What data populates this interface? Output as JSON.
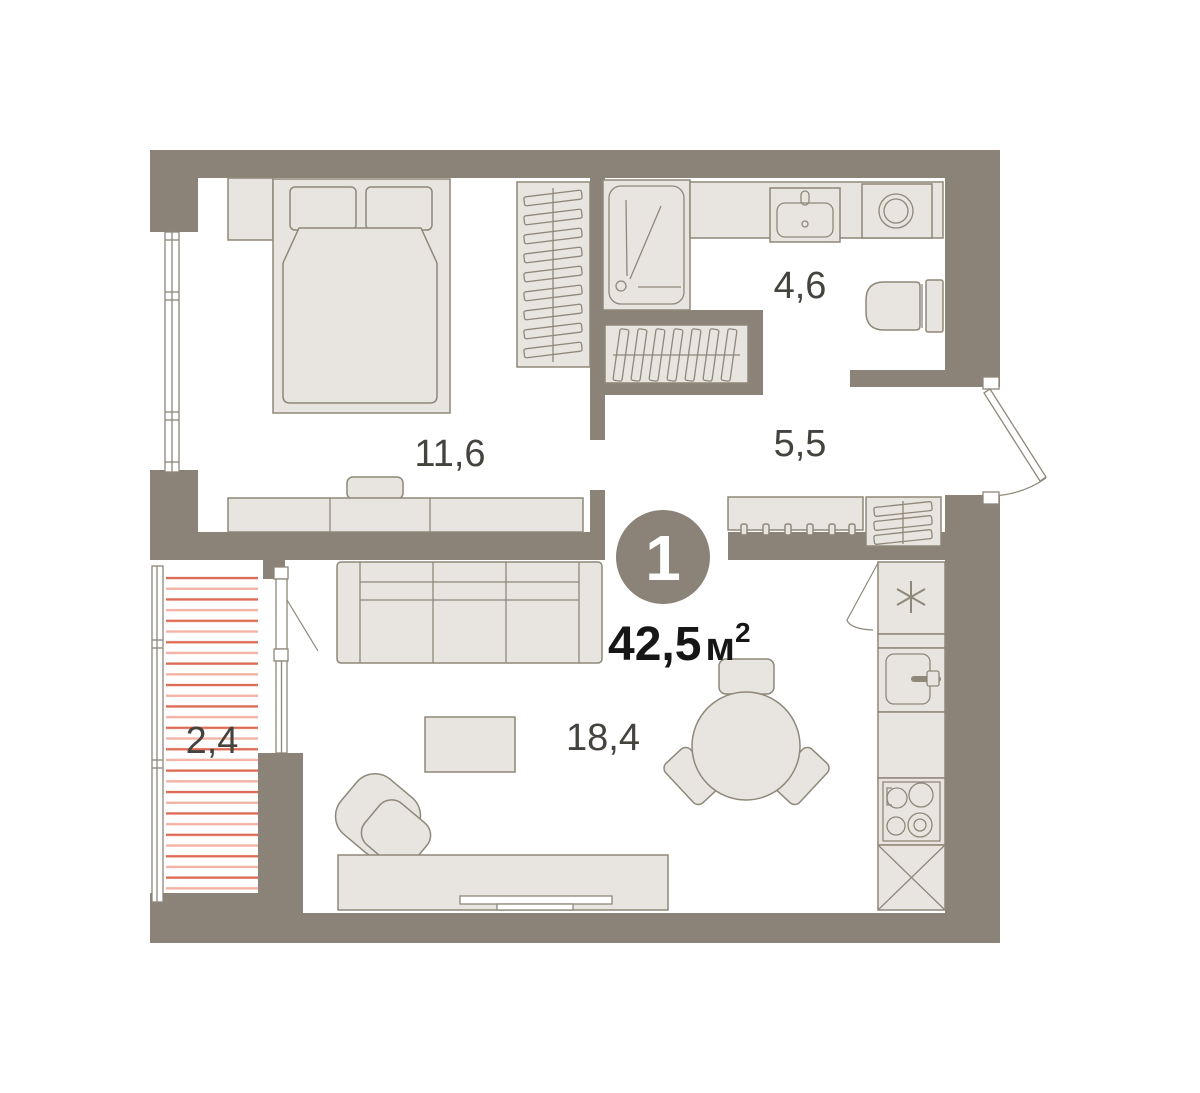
{
  "unit": {
    "number": "1",
    "area": "42,5",
    "area_unit": "м",
    "area_sup": "2"
  },
  "rooms": {
    "bedroom": {
      "area": "11,6"
    },
    "bathroom": {
      "area": "4,6"
    },
    "hallway": {
      "area": "5,5"
    },
    "living_kitchen": {
      "area": "18,4"
    },
    "balcony": {
      "area": "2,4"
    }
  },
  "colors": {
    "wall": "#8b8278",
    "furniture": "#e8e5e0",
    "outline": "#8f8779",
    "hatch-dark": "#dd6b54",
    "hatch-light": "#f3b2a4",
    "label": "#45433e",
    "area-text": "#161616",
    "floor": "#ffffff"
  }
}
